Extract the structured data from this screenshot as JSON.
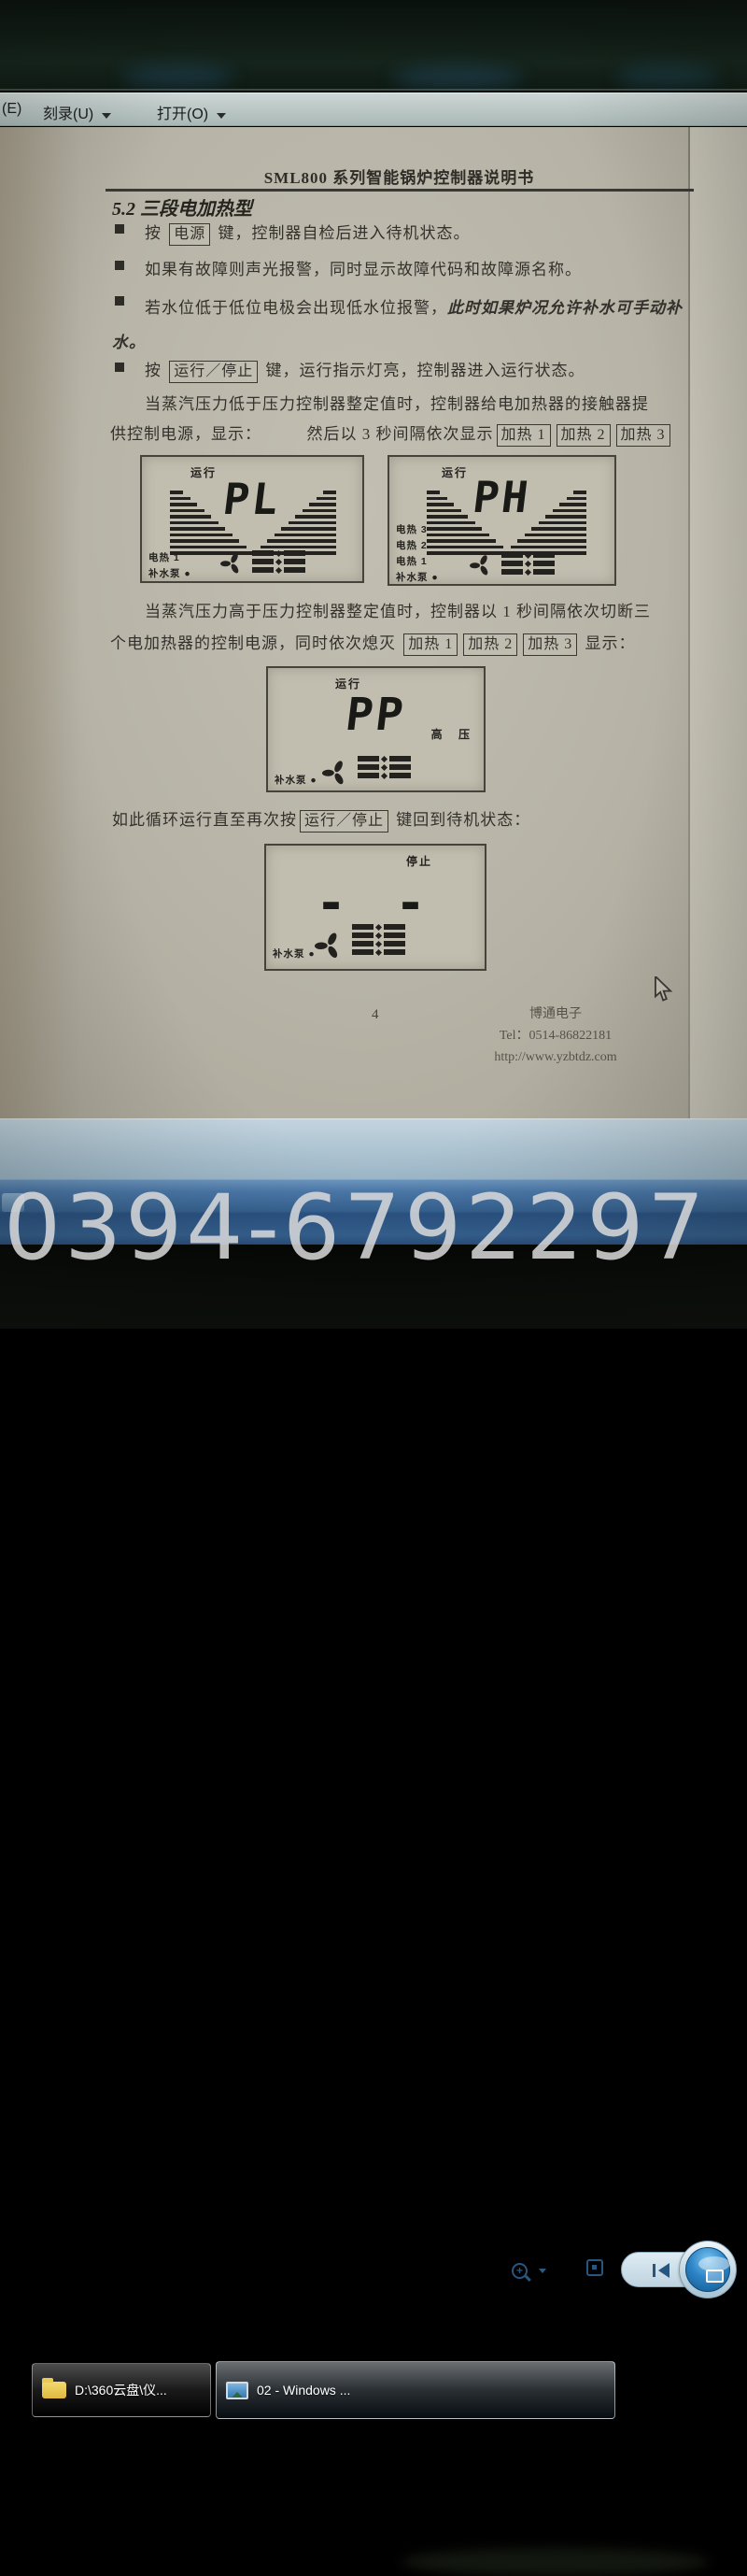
{
  "menu_bar": {
    "partial_item": "(E)",
    "burn_label": "刻录(U)",
    "open_label": "打开(O)"
  },
  "document": {
    "title": "SML800 系列智能锅炉控制器说明书",
    "section_heading": "5.2 三段电加热型",
    "bullets": {
      "b1_pre": "按",
      "b1_key": "电源",
      "b1_post": "键，控制器自检后进入待机状态。",
      "b2": "如果有故障则声光报警，同时显示故障代码和故障源名称。",
      "b3_normal": "若水位低于低位电极会出现低水位报警，",
      "b3_italic": "此时如果炉况允许补水可手动补水。",
      "b4_pre": "按",
      "b4_key": "运行／停止",
      "b4_post": "键，运行指示灯亮，控制器进入运行状态。"
    },
    "para_low": {
      "line1": "当蒸汽压力低于压力控制器整定值时，控制器给电加热器的接触器提",
      "line2_pre": "供控制电源，显示：",
      "line2_mid": "然后以 3 秒间隔依次显示",
      "key1": "加热 1",
      "key2": "加热 2",
      "key3": "加热 3"
    },
    "para_high": {
      "line1": "当蒸汽压力高于压力控制器整定值时，控制器以 1 秒间隔依次切断三",
      "line2_pre": "个电加热器的控制电源，同时依次熄灭",
      "key1": "加热 1",
      "key2": "加热 2",
      "key3": "加热 3",
      "line2_post": "显示："
    },
    "para_loop": {
      "pre": "如此循环运行直至再次按",
      "key": "运行／停止",
      "post": "键回到待机状态："
    },
    "displays": {
      "pl": {
        "status": "运行",
        "value": "PL",
        "label1": "电热 1",
        "label2": "补水泵 ●"
      },
      "ph": {
        "status": "运行",
        "value": "PH",
        "label1": "电热 3",
        "label2": "电热 2",
        "label3": "电热 1",
        "label4": "补水泵 ●"
      },
      "pp": {
        "status": "运行",
        "value": "PP",
        "right_label": "高 压",
        "label1": "补水泵 ●"
      },
      "stop": {
        "status": "停止",
        "value": "- -",
        "label1": "补水泵 ●"
      }
    },
    "footer": {
      "page": "4",
      "company": "博通电子",
      "tel": "Tel：0514-86822181",
      "url": "http://www.yzbtdz.com"
    }
  },
  "taskbar": {
    "task1_label": "D:\\360云盘\\仪...",
    "task2_label": "02 - Windows ..."
  },
  "watermark_text": "0394-6792297",
  "colors": {
    "taskbar_blue": "#36618f",
    "chrome_blue": "#b0c6d3",
    "paper": "#b7b4a7",
    "accent_icon_blue": "#27567f"
  }
}
